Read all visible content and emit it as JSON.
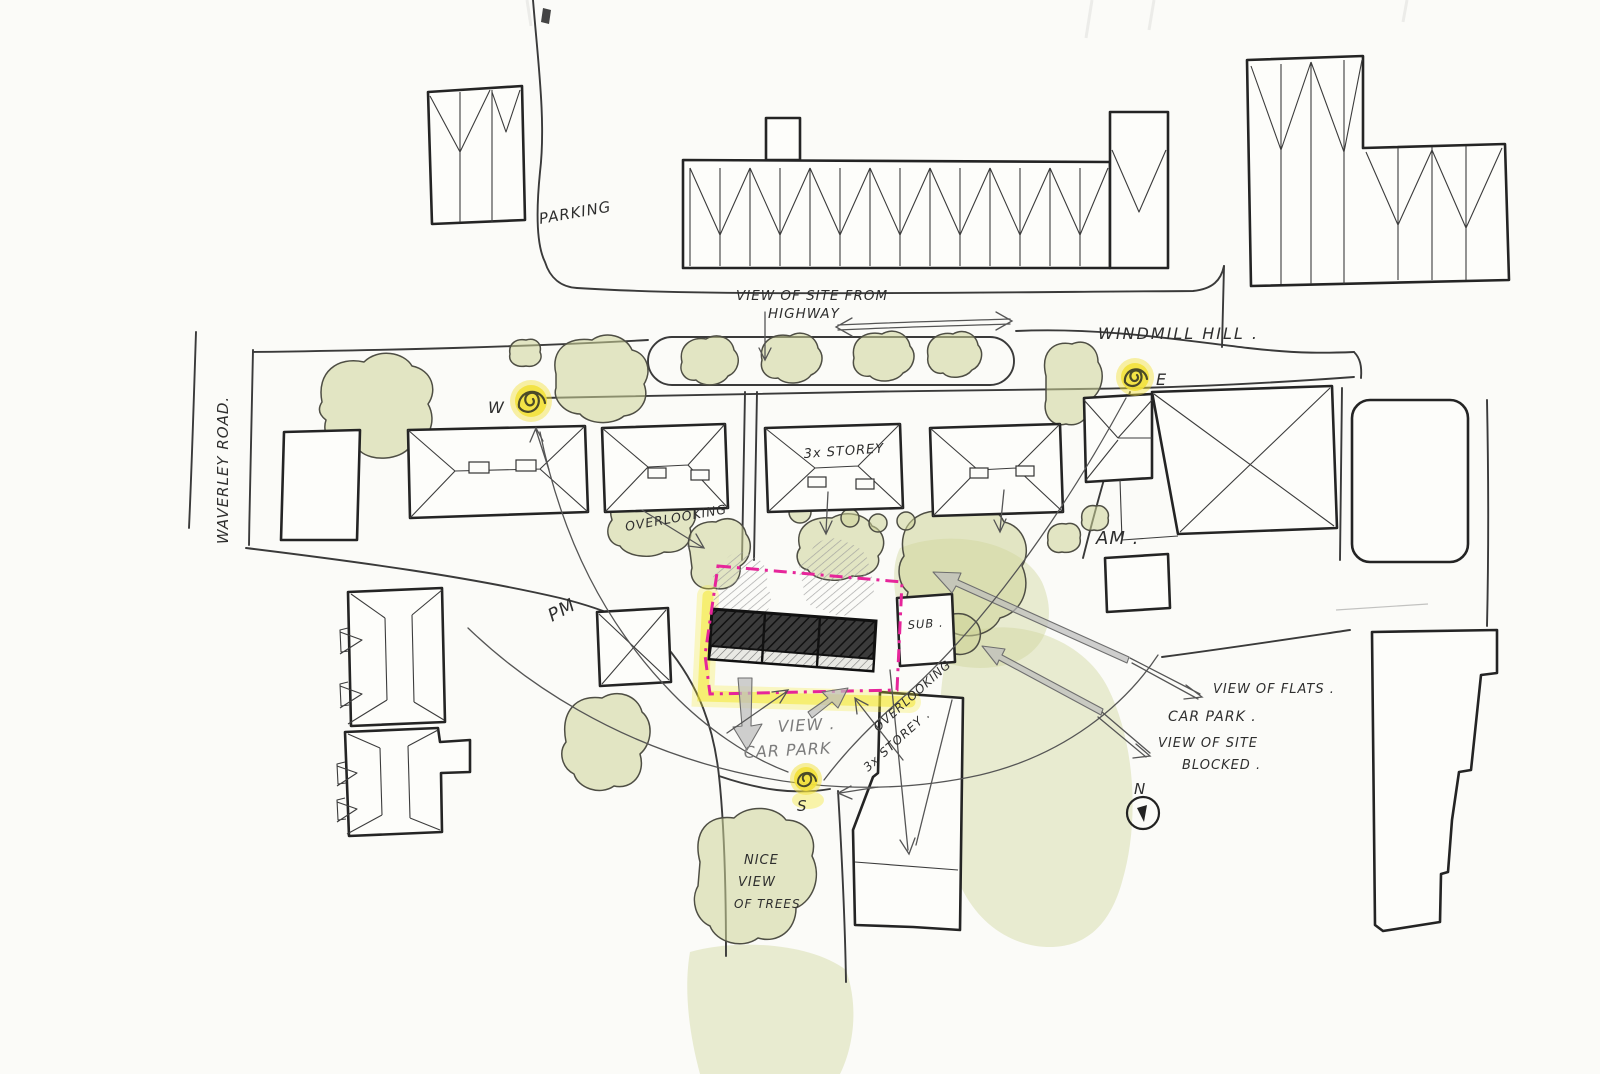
{
  "labels": {
    "parking": "PARKING",
    "view_of_site_from": "VIEW OF SITE FROM",
    "highway": "HIGHWAY",
    "windmill_hill": "WINDMILL HILL .",
    "waverley_road": "WAVERLEY ROAD.",
    "storey_top": "3x STOREY",
    "overlooking_top": "OVERLOOKING",
    "am": "AM .",
    "pm": "PM",
    "sub": "SUB .",
    "view_pencil": "VIEW .",
    "car_park_pencil": "CAR PARK",
    "overlooking_bottom": "OVERLOOKING",
    "storey_bottom": "3x STOREY .",
    "view_of_flats": "VIEW OF FLATS .",
    "car_park_right": "CAR PARK .",
    "view_of_site": "VIEW OF SITE",
    "blocked": "BLOCKED .",
    "nice": "NICE",
    "view_word": "VIEW",
    "of_trees": "OF TREES",
    "sun_west": "W",
    "sun_east": "E",
    "sun_south": "S",
    "north": "N"
  },
  "colors": {
    "ink": "#2e2e2e",
    "pencil_grey": "#7c7c7c",
    "tree_green": "#cdd398",
    "sun_yellow": "#f2e13c",
    "site_boundary_pink": "#e6259a",
    "site_highlight_yellow": "#f4e832",
    "arrow_grey": "#bcbcbc",
    "paper": "#fbfbf8"
  }
}
